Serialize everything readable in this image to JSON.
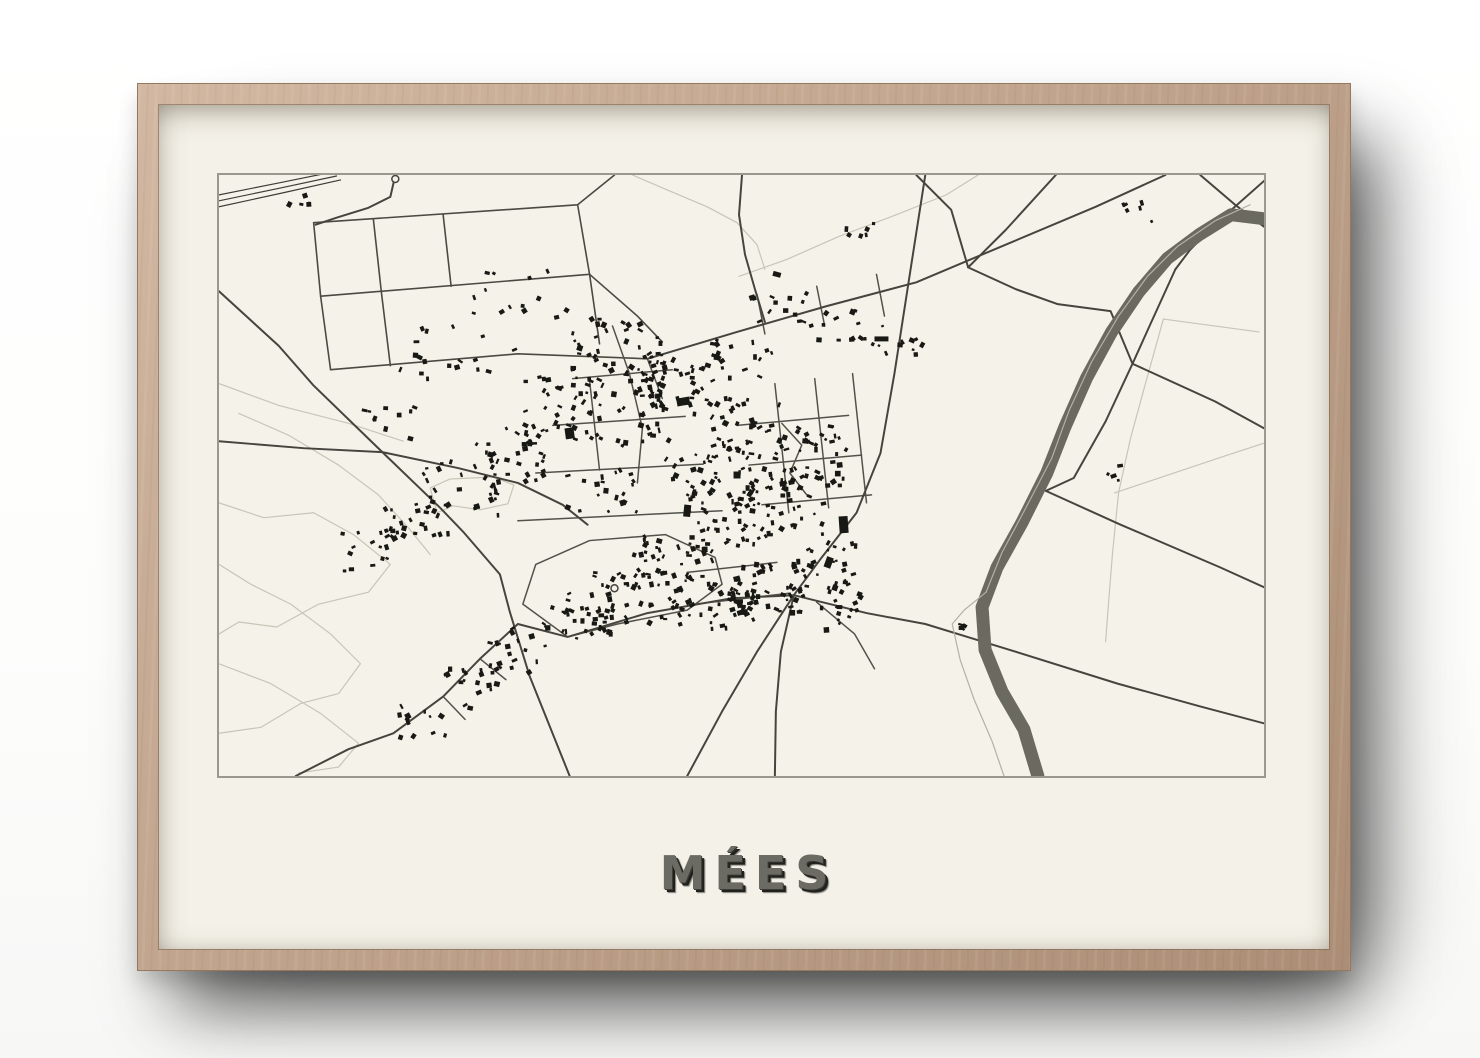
{
  "scene": {
    "description": "Framed minimalist street map poster on a white wall"
  },
  "poster": {
    "title": "MÉES"
  },
  "colors": {
    "wood": "#c2a58e",
    "mat": "#f4f1e8",
    "panel_border": "#9b988e",
    "road_major": "#45453e",
    "road_minor": "#52524b",
    "grid_line": "#4a4a43",
    "faint_path": "#c8c5b8",
    "railway": "#3d3d38",
    "river": "#6a6a60",
    "river_side_path": "#b4b1a3",
    "building": "#181815",
    "title_color": "#6b6b64",
    "title_shadow": "#20201d"
  },
  "map": {
    "viewbox": [
      0,
      0,
      1049,
      605
    ],
    "railway": [
      [
        [
          0,
          20
        ],
        [
          60,
          8
        ],
        [
          114,
          -3
        ]
      ],
      [
        [
          0,
          26
        ],
        [
          62,
          13
        ],
        [
          118,
          1
        ]
      ],
      [
        [
          0,
          32
        ],
        [
          64,
          18
        ],
        [
          122,
          5
        ]
      ]
    ],
    "grid": [
      [
        [
          95,
          48
        ],
        [
          360,
          30
        ],
        [
          397,
          0
        ]
      ],
      [
        [
          102,
          122
        ],
        [
          372,
          100
        ]
      ],
      [
        [
          112,
          196
        ],
        [
          300,
          180
        ],
        [
          430,
          185
        ]
      ],
      [
        [
          95,
          48
        ],
        [
          102,
          122
        ],
        [
          112,
          196
        ]
      ],
      [
        [
          360,
          30
        ],
        [
          372,
          100
        ],
        [
          382,
          170
        ]
      ],
      [
        [
          155,
          45
        ],
        [
          163,
          118
        ]
      ],
      [
        [
          225,
          40
        ],
        [
          233,
          112
        ]
      ],
      [
        [
          372,
          100
        ],
        [
          420,
          142
        ],
        [
          445,
          168
        ]
      ],
      [
        [
          163,
          118
        ],
        [
          172,
          192
        ]
      ]
    ],
    "major_roads": [
      [
        [
          0,
          117
        ],
        [
          60,
          172
        ],
        [
          95,
          212
        ],
        [
          165,
          280
        ],
        [
          222,
          335
        ],
        [
          245,
          359
        ],
        [
          282,
          402
        ],
        [
          292,
          440
        ],
        [
          312,
          505
        ],
        [
          352,
          605
        ]
      ],
      [
        [
          77,
          605
        ],
        [
          130,
          578
        ],
        [
          175,
          562
        ],
        [
          225,
          525
        ],
        [
          262,
          487
        ],
        [
          300,
          452
        ],
        [
          350,
          465
        ],
        [
          430,
          441
        ],
        [
          515,
          426
        ],
        [
          577,
          423
        ]
      ],
      [
        [
          709,
          0
        ],
        [
          695,
          90
        ],
        [
          678,
          200
        ],
        [
          664,
          280
        ],
        [
          640,
          340
        ],
        [
          605,
          385
        ],
        [
          577,
          423
        ],
        [
          564,
          480
        ],
        [
          559,
          540
        ],
        [
          558,
          605
        ]
      ],
      [
        [
          577,
          423
        ],
        [
          540,
          480
        ],
        [
          505,
          540
        ],
        [
          470,
          605
        ]
      ],
      [
        [
          577,
          423
        ],
        [
          650,
          441
        ],
        [
          709,
          452
        ],
        [
          800,
          480
        ],
        [
          902,
          512
        ],
        [
          985,
          535
        ],
        [
          1049,
          552
        ]
      ],
      [
        [
          430,
          185
        ],
        [
          520,
          158
        ],
        [
          610,
          132
        ],
        [
          700,
          108
        ],
        [
          790,
          70
        ],
        [
          880,
          32
        ],
        [
          950,
          0
        ]
      ],
      [
        [
          985,
          0
        ],
        [
          1020,
          30
        ],
        [
          1049,
          52
        ]
      ],
      [
        [
          1049,
          6
        ],
        [
          1005,
          45
        ],
        [
          975,
          75
        ],
        [
          960,
          95
        ]
      ],
      [
        [
          960,
          95
        ],
        [
          935,
          150
        ],
        [
          917,
          190
        ],
        [
          1000,
          228
        ],
        [
          1049,
          255
        ]
      ],
      [
        [
          917,
          190
        ],
        [
          890,
          248
        ],
        [
          858,
          305
        ],
        [
          830,
          318
        ],
        [
          905,
          352
        ],
        [
          1005,
          395
        ],
        [
          1049,
          415
        ]
      ],
      [
        [
          700,
          0
        ],
        [
          735,
          35
        ],
        [
          752,
          93
        ],
        [
          800,
          115
        ],
        [
          842,
          130
        ],
        [
          895,
          137
        ],
        [
          917,
          190
        ]
      ],
      [
        [
          752,
          93
        ],
        [
          790,
          55
        ],
        [
          840,
          0
        ]
      ],
      [
        [
          0,
          268
        ],
        [
          85,
          275
        ],
        [
          164,
          279
        ],
        [
          240,
          295
        ],
        [
          300,
          310
        ],
        [
          345,
          332
        ],
        [
          370,
          352
        ]
      ],
      [
        [
          177,
          0
        ],
        [
          172,
          22
        ],
        [
          150,
          33
        ],
        [
          118,
          43
        ],
        [
          97,
          50
        ]
      ],
      [
        [
          525,
          0
        ],
        [
          522,
          40
        ],
        [
          528,
          80
        ],
        [
          538,
          115
        ],
        [
          548,
          148
        ]
      ]
    ],
    "minor_roads": [
      [
        [
          395,
          152
        ],
        [
          412,
          200
        ],
        [
          425,
          255
        ],
        [
          420,
          310
        ]
      ],
      [
        [
          355,
          205
        ],
        [
          455,
          196
        ]
      ],
      [
        [
          335,
          252
        ],
        [
          468,
          243
        ]
      ],
      [
        [
          318,
          300
        ],
        [
          486,
          291
        ]
      ],
      [
        [
          300,
          348
        ],
        [
          505,
          338
        ]
      ],
      [
        [
          372,
          207
        ],
        [
          382,
          297
        ]
      ],
      [
        [
          520,
          252
        ],
        [
          632,
          242
        ]
      ],
      [
        [
          532,
          292
        ],
        [
          645,
          282
        ]
      ],
      [
        [
          545,
          332
        ],
        [
          655,
          322
        ]
      ],
      [
        [
          558,
          210
        ],
        [
          572,
          340
        ]
      ],
      [
        [
          598,
          205
        ],
        [
          612,
          335
        ]
      ],
      [
        [
          636,
          200
        ],
        [
          650,
          330
        ]
      ],
      [
        [
          565,
          250
        ],
        [
          585,
          272
        ],
        [
          573,
          300
        ],
        [
          590,
          322
        ]
      ],
      [
        [
          350,
          465
        ],
        [
          305,
          432
        ],
        [
          318,
          392
        ],
        [
          372,
          368
        ],
        [
          448,
          362
        ],
        [
          498,
          385
        ],
        [
          505,
          412
        ],
        [
          470,
          438
        ],
        [
          400,
          452
        ],
        [
          350,
          465
        ]
      ],
      [
        [
          470,
          400
        ],
        [
          560,
          390
        ]
      ],
      [
        [
          478,
          432
        ],
        [
          572,
          421
        ]
      ],
      [
        [
          540,
          120
        ],
        [
          548,
          160
        ]
      ],
      [
        [
          600,
          112
        ],
        [
          608,
          152
        ]
      ],
      [
        [
          660,
          100
        ],
        [
          668,
          142
        ]
      ],
      [
        [
          600,
          430
        ],
        [
          638,
          462
        ],
        [
          658,
          497
        ]
      ],
      [
        [
          225,
          525
        ],
        [
          247,
          548
        ]
      ],
      [
        [
          262,
          487
        ],
        [
          288,
          508
        ]
      ],
      [
        [
          430,
          185
        ],
        [
          445,
          225
        ]
      ]
    ],
    "faint_paths": [
      [
        [
          0,
          210
        ],
        [
          60,
          232
        ],
        [
          130,
          250
        ],
        [
          185,
          268
        ]
      ],
      [
        [
          0,
          330
        ],
        [
          45,
          345
        ],
        [
          95,
          340
        ],
        [
          135,
          362
        ],
        [
          172,
          392
        ],
        [
          150,
          420
        ],
        [
          100,
          432
        ],
        [
          58,
          455
        ],
        [
          20,
          450
        ],
        [
          0,
          462
        ]
      ],
      [
        [
          0,
          392
        ],
        [
          32,
          412
        ],
        [
          72,
          432
        ],
        [
          112,
          462
        ],
        [
          142,
          492
        ],
        [
          120,
          522
        ],
        [
          82,
          532
        ],
        [
          42,
          556
        ],
        [
          0,
          562
        ]
      ],
      [
        [
          0,
          492
        ],
        [
          52,
          512
        ],
        [
          102,
          542
        ],
        [
          140,
          572
        ],
        [
          120,
          596
        ],
        [
          80,
          602
        ]
      ],
      [
        [
          20,
          240
        ],
        [
          70,
          262
        ],
        [
          120,
          292
        ],
        [
          160,
          322
        ],
        [
          190,
          355
        ],
        [
          212,
          382
        ]
      ],
      [
        [
          212,
          315
        ],
        [
          232,
          306
        ],
        [
          275,
          304
        ],
        [
          296,
          312
        ],
        [
          290,
          331
        ],
        [
          262,
          337
        ],
        [
          235,
          333
        ],
        [
          219,
          340
        ],
        [
          212,
          315
        ]
      ],
      [
        [
          415,
          0
        ],
        [
          450,
          15
        ],
        [
          490,
          32
        ],
        [
          520,
          48
        ],
        [
          540,
          70
        ],
        [
          548,
          95
        ]
      ],
      [
        [
          522,
          102
        ],
        [
          570,
          85
        ],
        [
          622,
          62
        ],
        [
          680,
          40
        ],
        [
          730,
          20
        ],
        [
          762,
          0
        ]
      ],
      [
        [
          948,
          145
        ],
        [
          1044,
          158
        ]
      ],
      [
        [
          948,
          145
        ],
        [
          930,
          210
        ],
        [
          915,
          265
        ],
        [
          903,
          320
        ],
        [
          897,
          380
        ],
        [
          893,
          430
        ],
        [
          890,
          470
        ]
      ],
      [
        [
          899,
          320
        ],
        [
          1012,
          282
        ],
        [
          1049,
          270
        ]
      ]
    ],
    "river": [
      [
        1049,
        44
      ],
      [
        1016,
        40
      ],
      [
        984,
        60
      ],
      [
        952,
        84
      ],
      [
        923,
        118
      ],
      [
        896,
        158
      ],
      [
        871,
        204
      ],
      [
        849,
        254
      ],
      [
        831,
        300
      ],
      [
        806,
        350
      ],
      [
        781,
        395
      ],
      [
        766,
        435
      ],
      [
        769,
        478
      ],
      [
        786,
        520
      ],
      [
        808,
        558
      ],
      [
        822,
        605
      ]
    ],
    "river_side_path": [
      [
        1035,
        30
      ],
      [
        1000,
        46
      ],
      [
        962,
        72
      ],
      [
        932,
        102
      ],
      [
        903,
        142
      ],
      [
        876,
        188
      ],
      [
        853,
        238
      ],
      [
        836,
        285
      ],
      [
        810,
        335
      ],
      [
        786,
        380
      ],
      [
        770,
        420
      ],
      [
        748,
        438
      ],
      [
        736,
        452
      ],
      [
        744,
        488
      ],
      [
        758,
        528
      ],
      [
        776,
        570
      ],
      [
        788,
        605
      ]
    ],
    "clusters": [
      [
        400,
        185,
        45,
        40,
        55
      ],
      [
        345,
        235,
        40,
        35,
        40
      ],
      [
        295,
        280,
        40,
        30,
        32
      ],
      [
        245,
        315,
        40,
        28,
        28
      ],
      [
        195,
        350,
        35,
        25,
        22
      ],
      [
        150,
        380,
        30,
        22,
        16
      ],
      [
        460,
        215,
        40,
        32,
        45
      ],
      [
        530,
        260,
        40,
        35,
        45
      ],
      [
        590,
        285,
        40,
        32,
        45
      ],
      [
        565,
        330,
        45,
        35,
        55
      ],
      [
        505,
        345,
        40,
        32,
        45
      ],
      [
        455,
        390,
        40,
        30,
        40
      ],
      [
        415,
        425,
        40,
        28,
        38
      ],
      [
        360,
        445,
        35,
        25,
        28
      ],
      [
        495,
        430,
        45,
        28,
        48
      ],
      [
        555,
        415,
        40,
        28,
        45
      ],
      [
        610,
        395,
        30,
        25,
        25
      ],
      [
        300,
        480,
        30,
        25,
        18
      ],
      [
        255,
        515,
        28,
        22,
        18
      ],
      [
        205,
        550,
        25,
        20,
        12
      ],
      [
        560,
        135,
        30,
        18,
        14
      ],
      [
        620,
        150,
        30,
        18,
        14
      ],
      [
        680,
        165,
        28,
        16,
        12
      ],
      [
        625,
        440,
        25,
        18,
        14
      ],
      [
        82,
        22,
        12,
        8,
        5
      ],
      [
        922,
        38,
        15,
        10,
        6
      ],
      [
        900,
        300,
        10,
        8,
        3
      ],
      [
        742,
        455,
        8,
        6,
        3
      ],
      [
        640,
        55,
        18,
        10,
        6
      ],
      [
        240,
        180,
        60,
        30,
        18
      ],
      [
        300,
        120,
        50,
        25,
        14
      ],
      [
        170,
        250,
        30,
        20,
        10
      ],
      [
        430,
        250,
        30,
        30,
        20
      ],
      [
        385,
        320,
        35,
        25,
        20
      ],
      [
        525,
        185,
        30,
        20,
        18
      ],
      [
        475,
        300,
        30,
        25,
        20
      ]
    ],
    "big_buildings": [
      [
        466,
        228,
        13,
        8,
        -10
      ],
      [
        470,
        338,
        7,
        12,
        6
      ],
      [
        627,
        352,
        9,
        17,
        -4
      ],
      [
        612,
        390,
        7,
        11,
        20
      ],
      [
        520,
        302,
        7,
        7,
        0
      ],
      [
        352,
        260,
        9,
        11,
        -8
      ],
      [
        665,
        165,
        14,
        5,
        0
      ],
      [
        560,
        100,
        8,
        5,
        15
      ],
      [
        745,
        456,
        5,
        4,
        0
      ],
      [
        898,
        303,
        6,
        4,
        -20
      ]
    ],
    "roundabouts": [
      [
        177,
        4
      ],
      [
        397,
        416
      ]
    ]
  }
}
